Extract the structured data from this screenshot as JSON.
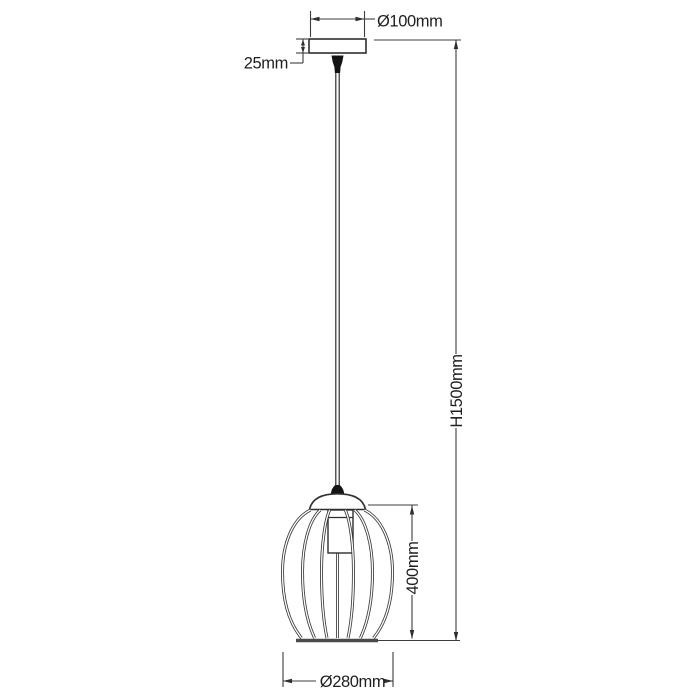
{
  "labels": {
    "canopy_diameter": "Ø100mm",
    "canopy_height": "25mm",
    "overall_height": "H1500mm",
    "shade_height": "400mm",
    "shade_diameter": "Ø280mm"
  },
  "colors": {
    "background": "#ffffff",
    "object_line": "#2e2e2e",
    "dimension_line": "#3c3c3c",
    "text": "#1f1f1f",
    "cord_grip_fill": "#141414"
  }
}
